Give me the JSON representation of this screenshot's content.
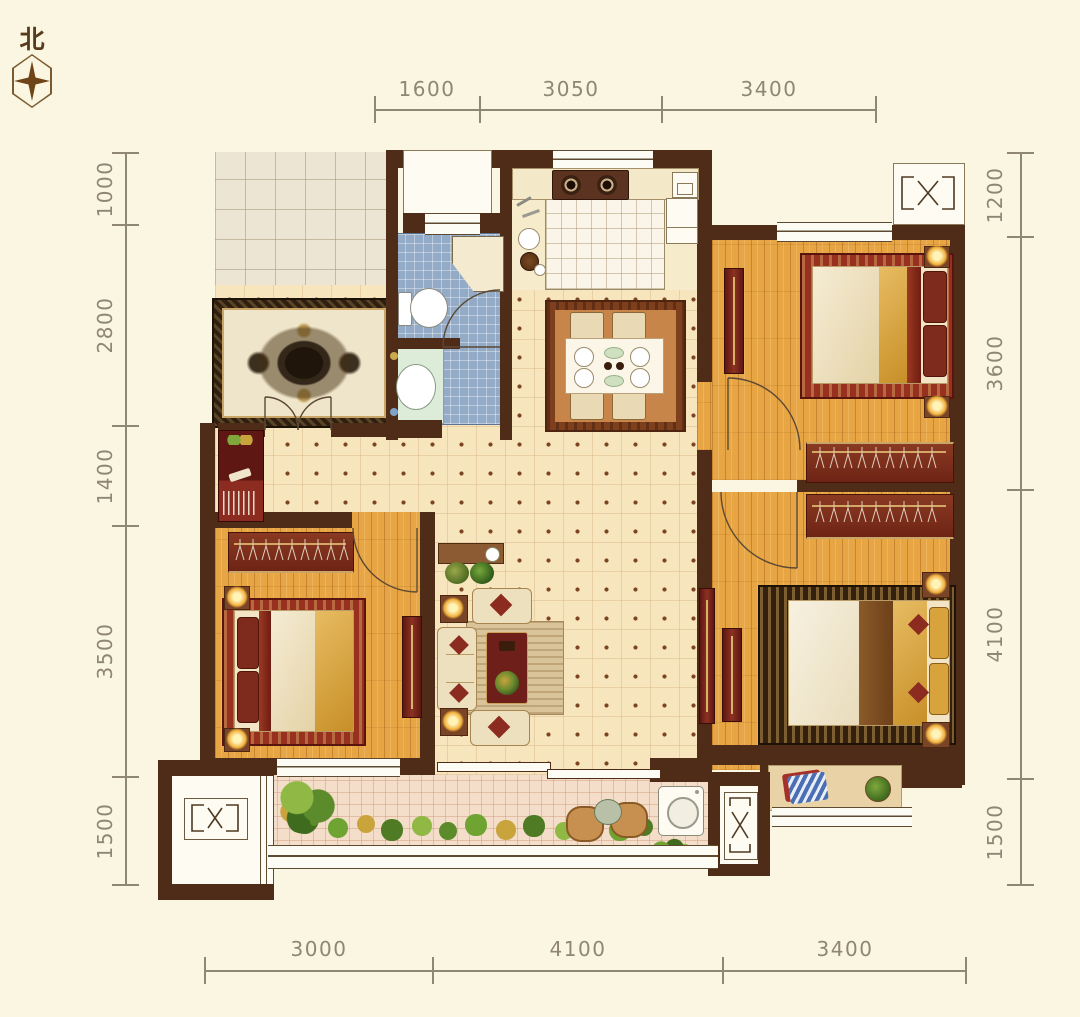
{
  "compass": {
    "label": "北"
  },
  "dimensions": {
    "top": [
      "1600",
      "3050",
      "3400"
    ],
    "bottom": [
      "3000",
      "4100",
      "3400"
    ],
    "left": [
      "1000",
      "2800",
      "1400",
      "3500",
      "1500"
    ],
    "right": [
      "1200",
      "3600",
      "4100",
      "1500"
    ]
  },
  "colors": {
    "background": "#FBF6E1",
    "wall": "#4E2C18",
    "wood_floor": "#E8A544",
    "tile_floor": "#F7E5BE",
    "bath_tile": "#93ABC6",
    "balcony_tile": "#F5DEC9",
    "furniture_red": "#6E1F1A",
    "rug_red": "#97301F",
    "gold": "#D8A23C",
    "dimension_text": "#8F8674"
  },
  "icons": {
    "compass_star": "four-point-star-icon",
    "ac_platform": "crossed-box-icon",
    "hangers": "clothes-hanger-icon"
  }
}
